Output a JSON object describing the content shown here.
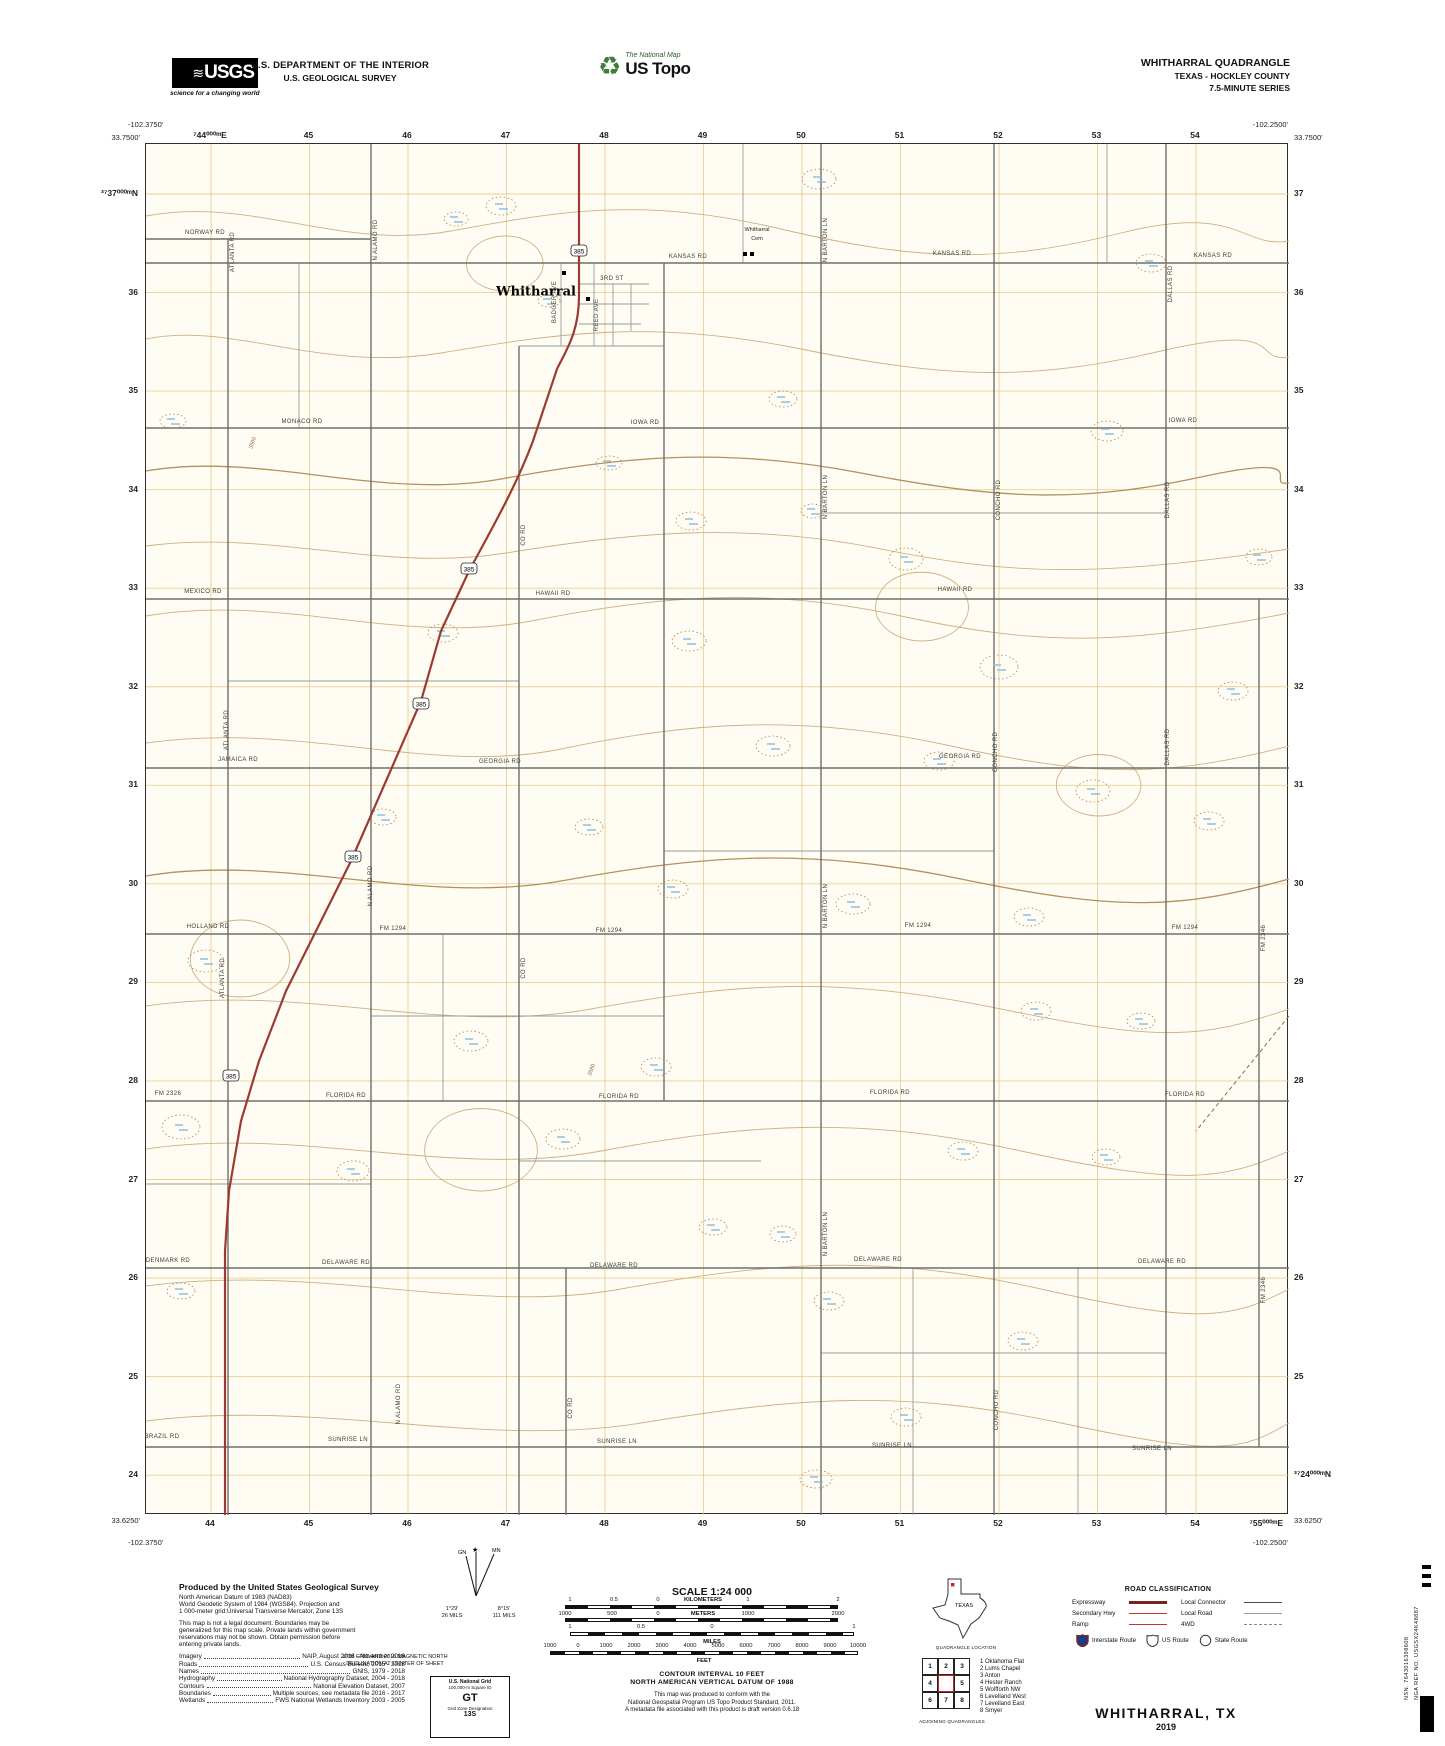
{
  "header": {
    "usgs_logo": "USGS",
    "usgs_tagline": "science for a changing world",
    "dept_line1": "U.S. DEPARTMENT OF THE INTERIOR",
    "dept_line2": "U.S. GEOLOGICAL SURVEY",
    "ustopo_brand": "The National Map",
    "ustopo_name": "US Topo",
    "quad_title": "WHITHARRAL QUADRANGLE",
    "quad_subtitle": "TEXAS - HOCKLEY COUNTY",
    "quad_series": "7.5-MINUTE SERIES"
  },
  "map": {
    "corners": {
      "tl_lon": "-102.3750'",
      "tl_lat": "33.7500'",
      "tr_lon": "-102.2500'",
      "tr_lat": "33.7500'",
      "bl_lat": "33.6250'",
      "bl_lon": "-102.3750'",
      "br_lat": "33.6250'",
      "br_lon": "-102.2500'",
      "br_easting_full": "⁷55⁰⁰⁰ᵐE",
      "br_northing_full": "³⁷24⁰⁰⁰ᵐN"
    },
    "eastings_top": [
      "⁷44⁰⁰⁰ᵐE",
      "45",
      "46",
      "47",
      "48",
      "49",
      "50",
      "51",
      "52",
      "53",
      "54"
    ],
    "eastings_bottom": [
      "44",
      "45",
      "46",
      "47",
      "48",
      "49",
      "50",
      "51",
      "52",
      "53",
      "54"
    ],
    "northings_left": [
      "³⁷37⁰⁰⁰ᵐN",
      "36",
      "35",
      "34",
      "33",
      "32",
      "31",
      "30",
      "29",
      "28",
      "27",
      "26",
      "25",
      "24"
    ],
    "northings_right": [
      "37",
      "36",
      "35",
      "34",
      "33",
      "32",
      "31",
      "30",
      "29",
      "28",
      "27",
      "26",
      "25",
      ""
    ],
    "town": "Whitharral",
    "cem_line1": "Whitharral",
    "cem_line2": "Cem",
    "shield": "385",
    "shield_pos": [
      [
        578,
        250
      ],
      [
        468,
        568
      ],
      [
        420,
        703
      ],
      [
        352,
        856
      ],
      [
        230,
        1075
      ]
    ],
    "red_path": "M578,143 L578,295 C578,330 566,348 556,368 L532,440 C515,485 495,520 468,570 L440,630 L420,700 L385,780 L350,860 L315,930 L285,990 L258,1060 L240,1120 L228,1190 L224,1250 L224,1514",
    "roads_h": [
      {
        "t": "NORWAY RD",
        "x": 205,
        "y": 233
      },
      {
        "t": "KANSAS RD",
        "x": 688,
        "y": 257
      },
      {
        "t": "KANSAS RD",
        "x": 952,
        "y": 254
      },
      {
        "t": "KANSAS RD",
        "x": 1213,
        "y": 256
      },
      {
        "t": "MONACO RD",
        "x": 302,
        "y": 422
      },
      {
        "t": "IOWA RD",
        "x": 645,
        "y": 423
      },
      {
        "t": "IOWA RD",
        "x": 1183,
        "y": 421
      },
      {
        "t": "MEXICO RD",
        "x": 203,
        "y": 592
      },
      {
        "t": "HAWAII RD",
        "x": 553,
        "y": 594
      },
      {
        "t": "HAWAII RD",
        "x": 955,
        "y": 590
      },
      {
        "t": "JAMAICA RD",
        "x": 238,
        "y": 760
      },
      {
        "t": "GEORGIA RD",
        "x": 500,
        "y": 762
      },
      {
        "t": "GEORGIA RD",
        "x": 960,
        "y": 757
      },
      {
        "t": "HOLLAND RD",
        "x": 208,
        "y": 927
      },
      {
        "t": "FM 1294",
        "x": 393,
        "y": 929
      },
      {
        "t": "FM 1294",
        "x": 609,
        "y": 931
      },
      {
        "t": "FM 1294",
        "x": 918,
        "y": 926
      },
      {
        "t": "FM 1294",
        "x": 1185,
        "y": 928
      },
      {
        "t": "FM 2326",
        "x": 168,
        "y": 1094
      },
      {
        "t": "FLORIDA RD",
        "x": 346,
        "y": 1096
      },
      {
        "t": "FLORIDA RD",
        "x": 619,
        "y": 1097
      },
      {
        "t": "FLORIDA RD",
        "x": 890,
        "y": 1093
      },
      {
        "t": "FLORIDA RD",
        "x": 1185,
        "y": 1095
      },
      {
        "t": "DENMARK RD",
        "x": 168,
        "y": 1261
      },
      {
        "t": "DELAWARE RD",
        "x": 346,
        "y": 1263
      },
      {
        "t": "DELAWARE RD",
        "x": 614,
        "y": 1266
      },
      {
        "t": "DELAWARE RD",
        "x": 878,
        "y": 1260
      },
      {
        "t": "DELAWARE RD",
        "x": 1162,
        "y": 1262
      },
      {
        "t": "BRAZIL RD",
        "x": 162,
        "y": 1437
      },
      {
        "t": "SUNRISE LN",
        "x": 348,
        "y": 1440
      },
      {
        "t": "SUNRISE LN",
        "x": 617,
        "y": 1442
      },
      {
        "t": "SUNRISE LN",
        "x": 892,
        "y": 1446
      },
      {
        "t": "SUNRISE LN",
        "x": 1152,
        "y": 1449
      },
      {
        "t": "3RD ST",
        "x": 612,
        "y": 279
      }
    ],
    "roads_v": [
      {
        "t": "ATLANTA RD",
        "x": 233,
        "y": 252
      },
      {
        "t": "ATLANTA RD",
        "x": 227,
        "y": 730
      },
      {
        "t": "ATLANTA RD",
        "x": 223,
        "y": 978
      },
      {
        "t": "N ALAMO RD",
        "x": 376,
        "y": 240
      },
      {
        "t": "N ALAMO RD",
        "x": 371,
        "y": 886
      },
      {
        "t": "N ALAMO RD",
        "x": 399,
        "y": 1404
      },
      {
        "t": "BADGER AVE",
        "x": 555,
        "y": 302
      },
      {
        "t": "REED AVE",
        "x": 597,
        "y": 315
      },
      {
        "t": "CO RD",
        "x": 524,
        "y": 535
      },
      {
        "t": "CO RD",
        "x": 524,
        "y": 968
      },
      {
        "t": "CO RD",
        "x": 571,
        "y": 1408
      },
      {
        "t": "N BARTON LN",
        "x": 826,
        "y": 240
      },
      {
        "t": "N BARTON LN",
        "x": 826,
        "y": 497
      },
      {
        "t": "N BARTON LN",
        "x": 826,
        "y": 906
      },
      {
        "t": "N BARTON LN",
        "x": 826,
        "y": 1234
      },
      {
        "t": "CONCHO RD",
        "x": 999,
        "y": 500
      },
      {
        "t": "CONCHO RD",
        "x": 996,
        "y": 752
      },
      {
        "t": "CONCHO RD",
        "x": 997,
        "y": 1410
      },
      {
        "t": "DALLAS RD",
        "x": 1171,
        "y": 284
      },
      {
        "t": "DALLAS RD",
        "x": 1168,
        "y": 500
      },
      {
        "t": "DALLAS RD",
        "x": 1168,
        "y": 747
      },
      {
        "t": "FM 2346",
        "x": 1264,
        "y": 938
      },
      {
        "t": "FM 2346",
        "x": 1264,
        "y": 1290
      }
    ],
    "contour_labels": [
      {
        "t": "3560",
        "x": 253,
        "y": 443
      },
      {
        "t": "3580",
        "x": 592,
        "y": 1070
      }
    ],
    "lines": {
      "h_dark": [
        {
          "y": 238,
          "x1": 145,
          "x2": 370
        },
        {
          "y": 262,
          "x1": 145,
          "x2": 1288
        },
        {
          "y": 427,
          "x1": 145,
          "x2": 1288
        },
        {
          "y": 598,
          "x1": 145,
          "x2": 1288
        },
        {
          "y": 767,
          "x1": 145,
          "x2": 1288
        },
        {
          "y": 933,
          "x1": 145,
          "x2": 1288
        },
        {
          "y": 1100,
          "x1": 145,
          "x2": 1288
        },
        {
          "y": 1267,
          "x1": 145,
          "x2": 1288
        },
        {
          "y": 1446,
          "x1": 145,
          "x2": 1288
        }
      ],
      "h_light": [
        {
          "y": 283,
          "x1": 578,
          "x2": 648
        },
        {
          "y": 303,
          "x1": 578,
          "x2": 648
        },
        {
          "y": 323,
          "x1": 578,
          "x2": 640
        },
        {
          "y": 345,
          "x1": 518,
          "x2": 663
        },
        {
          "y": 512,
          "x1": 820,
          "x2": 1165
        },
        {
          "y": 680,
          "x1": 227,
          "x2": 518
        },
        {
          "y": 850,
          "x1": 663,
          "x2": 993
        },
        {
          "y": 1015,
          "x1": 370,
          "x2": 663
        },
        {
          "y": 1160,
          "x1": 518,
          "x2": 760
        },
        {
          "y": 1183,
          "x1": 145,
          "x2": 370
        },
        {
          "y": 1352,
          "x1": 820,
          "x2": 1165
        }
      ],
      "v_dark": [
        {
          "x": 227,
          "y1": 238,
          "y2": 1514
        },
        {
          "x": 370,
          "y1": 143,
          "y2": 1514
        },
        {
          "x": 518,
          "y1": 345,
          "y2": 1514
        },
        {
          "x": 663,
          "y1": 262,
          "y2": 1100
        },
        {
          "x": 820,
          "y1": 143,
          "y2": 1514
        },
        {
          "x": 993,
          "y1": 143,
          "y2": 1514
        },
        {
          "x": 1165,
          "y1": 143,
          "y2": 1514
        },
        {
          "x": 1258,
          "y1": 598,
          "y2": 1446
        },
        {
          "x": 565,
          "y1": 1267,
          "y2": 1514
        }
      ],
      "v_light": [
        {
          "x": 560,
          "y1": 262,
          "y2": 345
        },
        {
          "x": 593,
          "y1": 262,
          "y2": 345
        },
        {
          "x": 612,
          "y1": 283,
          "y2": 345
        },
        {
          "x": 630,
          "y1": 283,
          "y2": 330
        },
        {
          "x": 298,
          "y1": 262,
          "y2": 427
        },
        {
          "x": 442,
          "y1": 933,
          "y2": 1100
        },
        {
          "x": 742,
          "y1": 143,
          "y2": 262
        },
        {
          "x": 912,
          "y1": 1267,
          "y2": 1514
        },
        {
          "x": 1077,
          "y1": 1267,
          "y2": 1514
        },
        {
          "x": 1106,
          "y1": 143,
          "y2": 262
        }
      ]
    },
    "buildings": [
      [
        583,
        250
      ],
      [
        563,
        272
      ],
      [
        587,
        298
      ],
      [
        744,
        253
      ],
      [
        751,
        253
      ]
    ],
    "wetlands": [
      [
        500,
        205,
        30,
        18
      ],
      [
        818,
        178,
        34,
        20
      ],
      [
        1150,
        262,
        30,
        18
      ],
      [
        1106,
        430,
        32,
        20
      ],
      [
        782,
        398,
        28,
        16
      ],
      [
        172,
        420,
        26,
        14
      ],
      [
        690,
        520,
        30,
        18
      ],
      [
        905,
        558,
        34,
        22
      ],
      [
        1258,
        556,
        26,
        16
      ],
      [
        442,
        632,
        30,
        18
      ],
      [
        688,
        640,
        34,
        20
      ],
      [
        998,
        666,
        38,
        24
      ],
      [
        1232,
        690,
        30,
        18
      ],
      [
        772,
        745,
        34,
        20
      ],
      [
        938,
        760,
        30,
        18
      ],
      [
        1092,
        790,
        34,
        22
      ],
      [
        1208,
        820,
        30,
        18
      ],
      [
        382,
        816,
        26,
        16
      ],
      [
        588,
        826,
        28,
        16
      ],
      [
        672,
        888,
        30,
        18
      ],
      [
        852,
        903,
        34,
        20
      ],
      [
        1028,
        916,
        30,
        18
      ],
      [
        205,
        960,
        36,
        22
      ],
      [
        470,
        1040,
        34,
        20
      ],
      [
        655,
        1066,
        30,
        18
      ],
      [
        1035,
        1010,
        30,
        18
      ],
      [
        1140,
        1020,
        28,
        16
      ],
      [
        180,
        1126,
        38,
        24
      ],
      [
        352,
        1170,
        32,
        20
      ],
      [
        562,
        1138,
        34,
        20
      ],
      [
        712,
        1226,
        28,
        16
      ],
      [
        782,
        1233,
        26,
        16
      ],
      [
        828,
        1300,
        30,
        18
      ],
      [
        962,
        1150,
        30,
        18
      ],
      [
        1105,
        1156,
        28,
        16
      ],
      [
        180,
        1290,
        28,
        16
      ],
      [
        1022,
        1340,
        30,
        18
      ],
      [
        815,
        1478,
        32,
        18
      ],
      [
        905,
        1416,
        30,
        18
      ],
      [
        548,
        300,
        22,
        12
      ],
      [
        455,
        218,
        24,
        14
      ],
      [
        608,
        462,
        26,
        14
      ],
      [
        812,
        510,
        24,
        14
      ]
    ]
  },
  "footer": {
    "produced_title": "Produced by the United States Geological Survey",
    "datum_lines": [
      "North American Datum of 1983 (NAD83)",
      "World Geodetic System of 1984 (WGS84).  Projection and",
      "1 000-meter grid:Universal Transverse Mercator, Zone 13S"
    ],
    "legal_lines": [
      "This map is not a legal document. Boundaries may be",
      "generalized for this map scale. Private lands within government",
      "reservations may not be shown. Obtain permission before",
      "entering private lands."
    ],
    "sources": [
      {
        "label": "Imagery",
        "value": "NAIP, August 2016 - November 2016"
      },
      {
        "label": "Roads",
        "value": "U.S. Census Bureau, 2015 - 2018"
      },
      {
        "label": "Names",
        "value": "GNIS, 1979 - 2018"
      },
      {
        "label": "Hydrography",
        "value": "National Hydrography Dataset, 2004 - 2018"
      },
      {
        "label": "Contours",
        "value": "National Elevation Dataset, 2007"
      },
      {
        "label": "Boundaries",
        "value": "Multiple sources; see metadata file 2016 - 2017"
      },
      {
        "label": "Wetlands",
        "value": "FWS National Wetlands Inventory 2003 - 2005"
      }
    ],
    "declination": {
      "star_label": "MN",
      "gn_label": "GN",
      "gn_deg": "1°29'",
      "gn_mils": "26 MILS",
      "mn_deg": "8°15'",
      "mn_mils": "111 MILS",
      "caption1": "UTM GRID AND 2016 MAGNETIC NORTH",
      "caption2": "DECLINATION AT CENTER OF SHEET"
    },
    "usng": {
      "title": "U.S. National Grid",
      "sq_label": "100,000-m Square ID",
      "sq": "GT",
      "gzd_label": "Grid Zone Designation",
      "gzd": "13S"
    },
    "scale": {
      "title": "SCALE 1:24 000",
      "km_ticks": [
        [
          "1",
          570
        ],
        [
          "0.5",
          614
        ],
        [
          "0",
          658
        ],
        [
          "1",
          748
        ],
        [
          "2",
          838
        ]
      ],
      "km_unit": "KILOMETERS",
      "m_ticks": [
        [
          "1000",
          565
        ],
        [
          "500",
          612
        ],
        [
          "0",
          658
        ],
        [
          "1000",
          748
        ],
        [
          "2000",
          838
        ]
      ],
      "m_unit": "METERS",
      "mi_ticks": [
        [
          "1",
          570
        ],
        [
          "0.5",
          641
        ],
        [
          "0",
          712
        ],
        [
          "1",
          854
        ]
      ],
      "mi_unit": "MILES",
      "ft_ticks": [
        [
          "1000",
          550
        ],
        [
          "0",
          578
        ],
        [
          "1000",
          606
        ],
        [
          "2000",
          634
        ],
        [
          "3000",
          662
        ],
        [
          "4000",
          690
        ],
        [
          "5000",
          718
        ],
        [
          "6000",
          746
        ],
        [
          "7000",
          774
        ],
        [
          "8000",
          802
        ],
        [
          "9000",
          830
        ],
        [
          "10000",
          858
        ]
      ],
      "ft_unit": "FEET",
      "contour_note": "CONTOUR INTERVAL 10 FEET",
      "datum_note": "NORTH AMERICAN VERTICAL DATUM OF 1988",
      "conformance": [
        "This map was produced to conform with the",
        "National Geospatial Program US Topo Product Standard, 2011.",
        "A metadata file associated with this product is draft version 0.6.18"
      ]
    },
    "state_inset": {
      "state": "TEXAS",
      "caption": "QUADRANGLE LOCATION"
    },
    "adjoining": {
      "cells": [
        "1",
        "2",
        "3",
        "4",
        "",
        "5",
        "6",
        "7",
        "8"
      ],
      "names": [
        "1 Oklahoma Flat",
        "2 Lums Chapel",
        "3 Anton",
        "4 Hester Ranch",
        "5 Wolfforth NW",
        "6 Levelland West",
        "7 Levelland East",
        "8 Smyer"
      ],
      "caption": "ADJOINING QUADRANGLES"
    },
    "road_class": {
      "title": "ROAD CLASSIFICATION",
      "rows": [
        {
          "l": "Expressway",
          "r": "Local Connector"
        },
        {
          "l": "Secondary Hwy",
          "r": "Local Road"
        },
        {
          "l": "Ramp",
          "r": "4WD"
        }
      ],
      "shields": [
        "Interstate Route",
        "US Route",
        "State Route"
      ]
    },
    "sheet_title": "WHITHARRAL,  TX",
    "sheet_year": "2019",
    "edge_text1": "NSN. 7643016398608",
    "edge_text2": "NGA REF NO. USGSX24K48887"
  },
  "colors": {
    "highway_red": "#9c3a32",
    "contour_brown": "#cdb084",
    "grid_orange": "#e3c57f",
    "wetland_blue": "#7fb6d9",
    "road_gray": "#6e6e6e"
  }
}
